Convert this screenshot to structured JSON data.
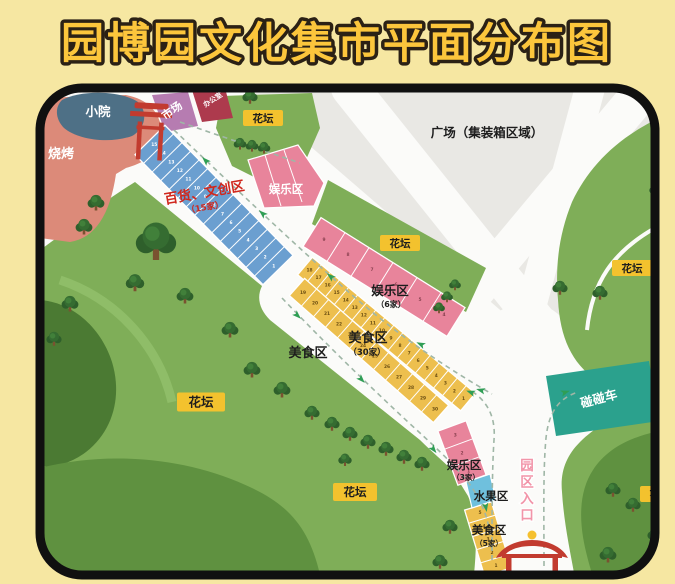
{
  "title": "园博园文化集市平面分布图",
  "areas": {
    "courtyard": {
      "name": "小院"
    },
    "bbq": {
      "name": "烧烤"
    },
    "market": {
      "name": "市场"
    },
    "office": {
      "name": "办公室"
    },
    "plaza": {
      "name": "广场（集装箱区域）"
    },
    "flowerbed": {
      "name": "花坛"
    },
    "retail": {
      "name": "百货、文创区",
      "count": "（15家）",
      "stalls": 15
    },
    "ent_top": {
      "name": "娱乐区"
    },
    "ent_mid": {
      "name": "娱乐区",
      "count": "（6家）",
      "stalls": 6
    },
    "ent_bottom": {
      "name": "娱乐区",
      "count": "（3家）",
      "stalls": 3
    },
    "food_main": {
      "name": "美食区",
      "count": "（30家）",
      "stalls": 30,
      "rows": [
        18,
        12
      ]
    },
    "food_side": {
      "name": "美食区"
    },
    "food_south": {
      "name": "美食区",
      "count": "（5家）",
      "stalls": 5
    },
    "fruit": {
      "name": "水果区"
    },
    "bumper": {
      "name": "碰碰车"
    },
    "entrance": {
      "name": "园区入口"
    }
  },
  "colors": {
    "bg": "#f6e7a2",
    "title": "#fcc63c",
    "titleOutline": "#2b2115",
    "border": "#101010",
    "road": "#fbfbf9",
    "plaza": "#e9e8e4",
    "grass": "#7fae58",
    "grassDark": "#4b7a33",
    "grassMid": "#5f9140",
    "grassBand": "#8fbd68",
    "courtyard": "#4e7086",
    "bbq": "#dc8a79",
    "market": "#b67cb1",
    "office": "#ad3a4d",
    "stallBlue": "#6b9fd0",
    "stallPink": "#e8849b",
    "stallYellow": "#edbf4e",
    "fruitBlue": "#6fc0dd",
    "bumper": "#2ba18d",
    "labelYellow": "#f3c22e",
    "retailText": "#d0271d",
    "entranceText": "#f295a9",
    "arrow": "#2f9e55",
    "dash": "#9fb6a6",
    "gate": "#c23b2f"
  }
}
